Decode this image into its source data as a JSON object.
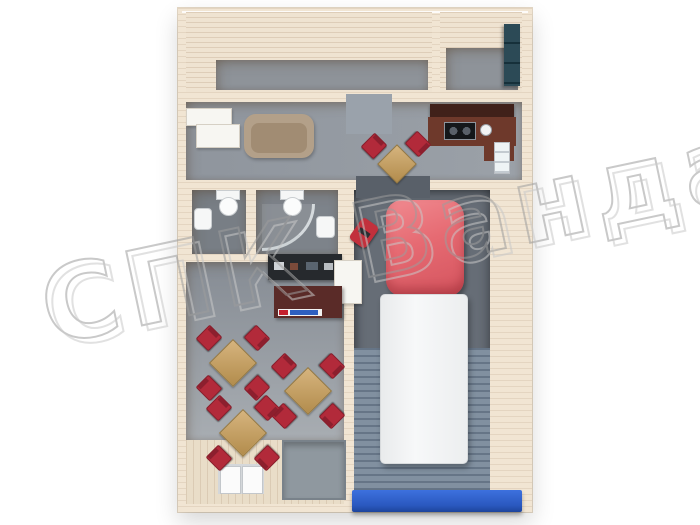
{
  "watermark": {
    "text": "СПК Ванда",
    "stroke_color": "#9d9d9d",
    "shadow_color": "#c9c9c9"
  },
  "scene": {
    "type": "3d-floor-plan-render",
    "description": "top-down render of a modular cafe/service building with garage bay and truck",
    "building": {
      "wall_color": "#f1e5d3",
      "rooms": [
        {
          "name": "storage-room-top-left",
          "floor_color": "#8e9399",
          "items": []
        },
        {
          "name": "utility-room-top-right",
          "floor_color": "#8e9399",
          "items": [
            "teal-shelf-unit"
          ]
        },
        {
          "name": "kitchen-corridor",
          "floor_color": "#959ba2",
          "items": [
            "white-wardrobe",
            "beige-sofa",
            "table-with-2-red-chairs",
            "dark-kitchen-counter",
            "two-burner-stove",
            "round-sink",
            "wall-window"
          ]
        },
        {
          "name": "bathroom-left",
          "floor_color": "#787e85",
          "items": [
            "toilet",
            "wash-sink"
          ]
        },
        {
          "name": "bathroom-right",
          "floor_color": "#7d838a",
          "items": [
            "toilet",
            "corner-shower",
            "wash-sink"
          ]
        },
        {
          "name": "cafe-hall",
          "floor_color": "#a8adb2",
          "items": [
            "dark-tool-shelf",
            "white-counter",
            "maroon-bar-counter",
            "table-with-4-red-chairs",
            "table-with-4-red-chairs",
            "table-with-4-red-chairs"
          ]
        },
        {
          "name": "entrance-porch",
          "floor_color": "#e9ddc8",
          "items": [
            "white-double-door",
            "gray-floor-mat"
          ]
        },
        {
          "name": "garage-bay",
          "floor_color": "#666d76",
          "items": [
            "box-truck",
            "red-floor-jack",
            "loading-ramp",
            "blue-roller-door"
          ]
        }
      ]
    },
    "truck": {
      "cab_color": "#e66a72",
      "body_color": "#f4f5f6"
    },
    "palette": {
      "chair_red": "#b22a3a",
      "table_wood": "#c8a36e",
      "garage_door_blue": "#2a58bf",
      "bar_maroon": "#5a2b28",
      "counter_brown": "#6e392b",
      "sofa_beige": "#b3a089",
      "shelf_teal": "#2c4a56",
      "ramp_blue_gray": "#8190a0"
    }
  }
}
